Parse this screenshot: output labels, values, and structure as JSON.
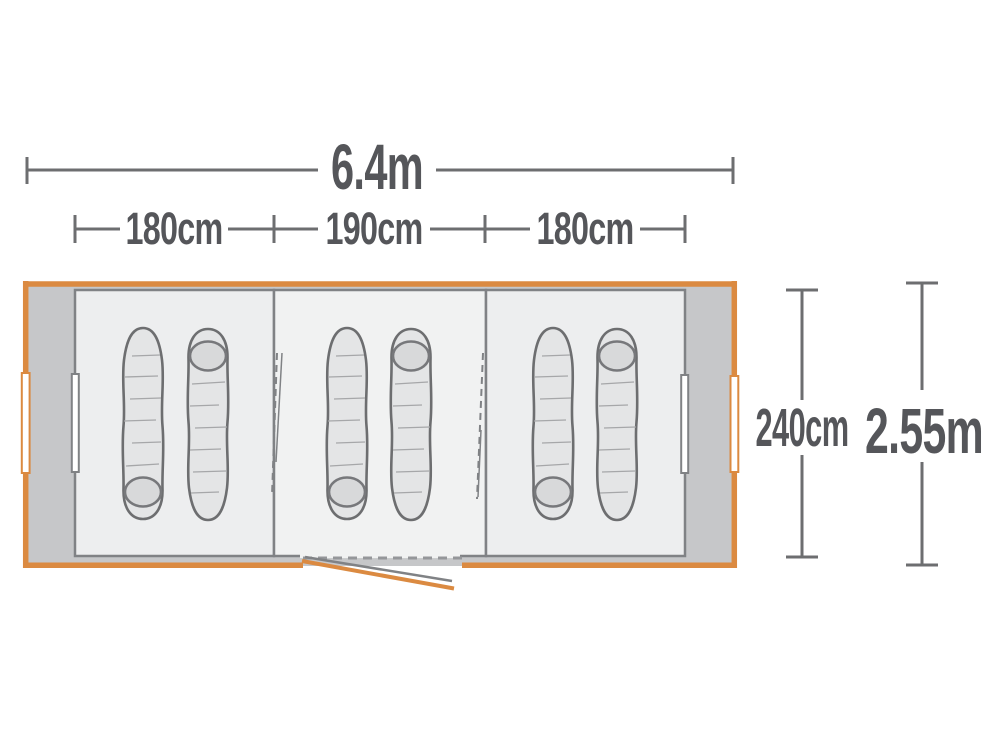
{
  "figure": {
    "kind": "tent floor plan diagram, top view",
    "overall_width": {
      "label": "6.4m"
    },
    "sections": [
      {
        "label": "180cm"
      },
      {
        "label": "190cm"
      },
      {
        "label": "180cm"
      }
    ],
    "inner_depth": {
      "label": "240cm"
    },
    "overall_depth": {
      "label": "2.55m"
    },
    "rooms": [
      {
        "name": "left sleeping room",
        "sleeping_bags": 2
      },
      {
        "name": "middle sleeping room",
        "sleeping_bags": 2
      },
      {
        "name": "right sleeping room",
        "sleeping_bags": 2
      }
    ],
    "colors": {
      "accent_orange": "#DB8A41",
      "dimension_line_gray": "#6D6E70",
      "dimension_text_gray": "#55565A",
      "canopy_gray": "#C6C7C9",
      "room_fill": "#EDEEEF",
      "middle_room_fill": "#F1F2F2",
      "bag_fill": "#E4E5E6",
      "bag_hood_fill": "#D8D9DA"
    }
  }
}
